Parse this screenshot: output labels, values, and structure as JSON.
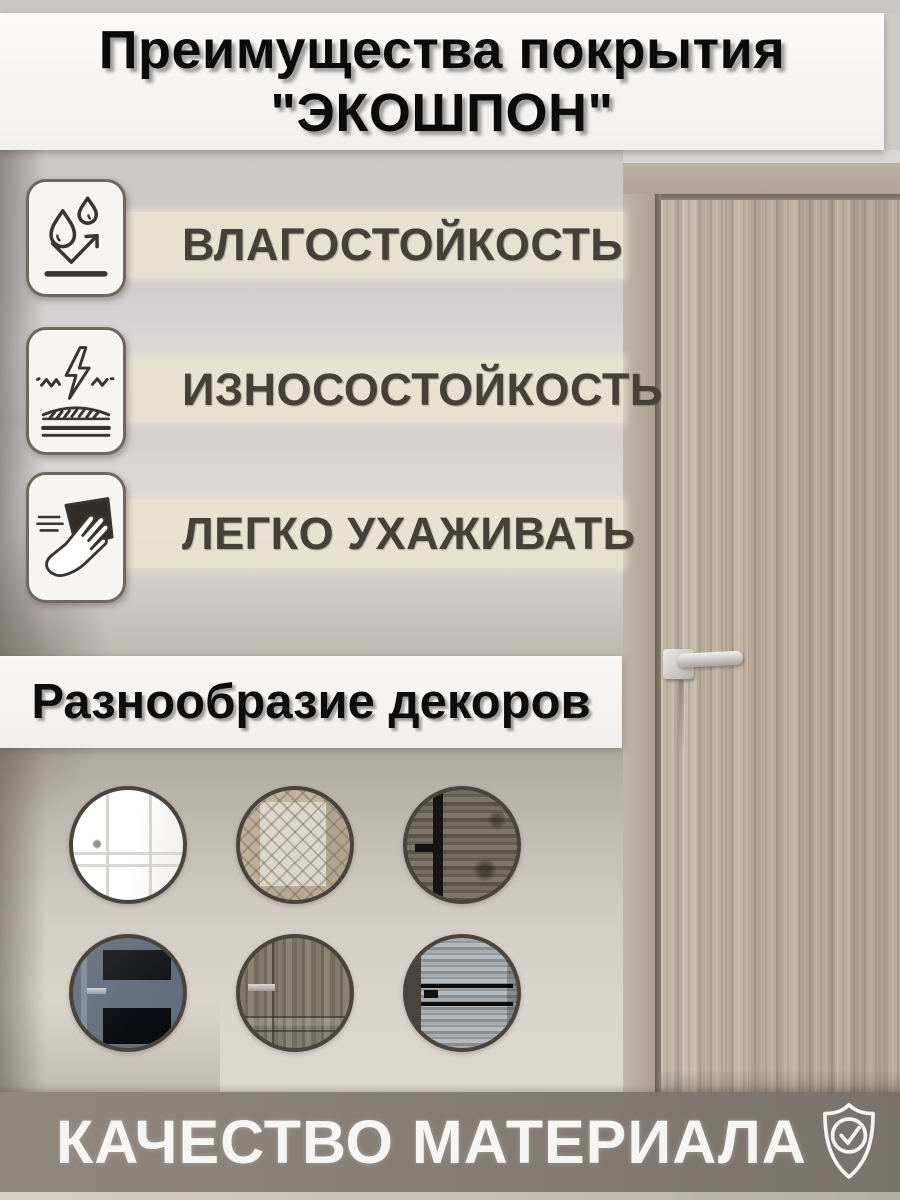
{
  "title": {
    "line1": "Преимущества покрытия",
    "line2": "\"ЭКОШПОН\""
  },
  "features": [
    {
      "label": "ВЛАГОСТОЙКОСТЬ",
      "icon": "water-drops-icon"
    },
    {
      "label": "ИЗНОСОСТОЙКОСТЬ",
      "icon": "wear-resistance-icon"
    },
    {
      "label": "ЛЕГКО УХАЖИВАТЬ",
      "icon": "easy-care-icon"
    }
  ],
  "decors_banner": {
    "label": "Разнообразие декоров"
  },
  "decor_circles": [
    {
      "id": "white-classic-door"
    },
    {
      "id": "glass-insert-door"
    },
    {
      "id": "dark-rustic-door"
    },
    {
      "id": "blue-grey-glass-door"
    },
    {
      "id": "grey-classic-panel-door"
    },
    {
      "id": "light-grey-plank-door"
    }
  ],
  "bottom_banner": {
    "label": "КАЧЕСТВО МАТЕРИАЛА",
    "icon": "shield-check-icon"
  },
  "colors": {
    "strip_beige": "#e9e1d0",
    "banner_white": "#f8f7f5",
    "bottom_taupe": "#867d74",
    "label_text": "#474039",
    "door_wood": "#b5a99b"
  }
}
